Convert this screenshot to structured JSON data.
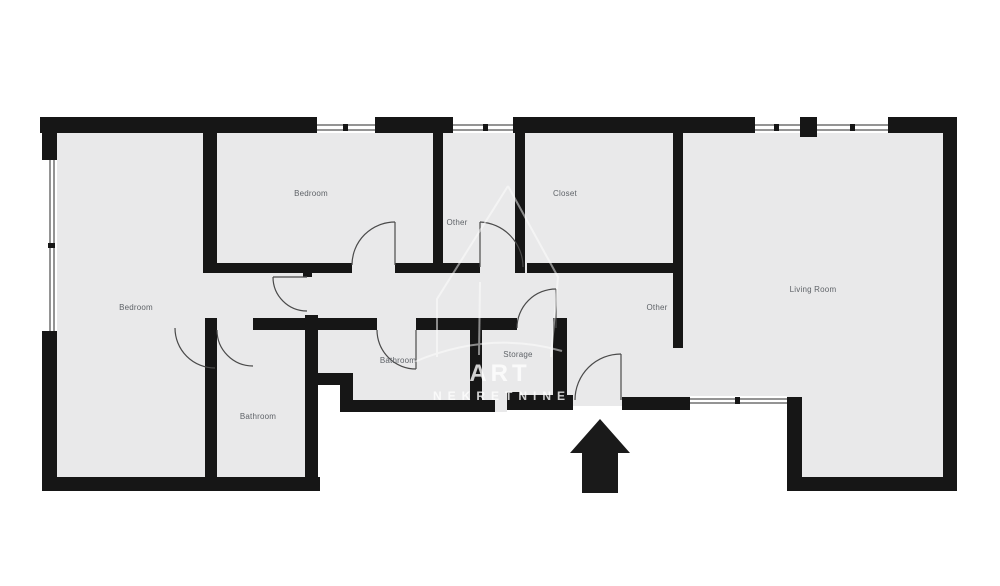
{
  "rooms": {
    "bedroom_left": "Bedroom",
    "bedroom_top": "Bedroom",
    "closet": "Closet",
    "hall_top": "Other",
    "living_room": "Living Room",
    "hall_bottom": "Other",
    "bathroom_middle": "Bathroom",
    "storage": "Storage",
    "bathroom_left": "Bathroom"
  },
  "watermark": {
    "line1": "ART",
    "line2": "NEKRETNINE"
  },
  "entrance_arrow": "up",
  "colors": {
    "wall": "#161616",
    "floor": "#e9e9ea",
    "label": "#5f6368",
    "background": "#ffffff",
    "watermark": "#ffffff",
    "window_line": "#2a2a2a",
    "door_line": "#4a4a4a"
  }
}
